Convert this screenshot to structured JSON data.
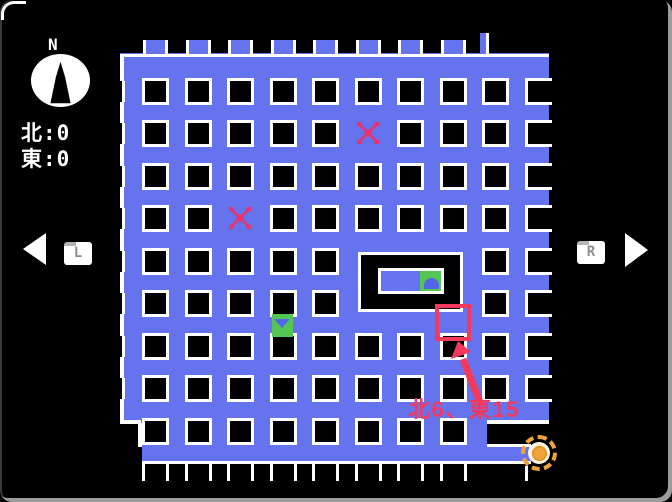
{
  "window": {
    "frame_color": "#9c9c9c",
    "screen_bg": "#000000"
  },
  "hud": {
    "compass": {
      "label": "N",
      "disc_color": "#ffffff",
      "needle_color": "#000000"
    },
    "coordinates": [
      {
        "label": "北",
        "separator": ":",
        "value": "0"
      },
      {
        "label": "東",
        "separator": ":",
        "value": "0"
      }
    ],
    "shoulder_buttons": [
      {
        "label": "L"
      },
      {
        "label": "R"
      }
    ]
  },
  "map": {
    "colors": {
      "floor": "#6673ef",
      "wall": "#000000",
      "outline": "#ffffff",
      "x_mark": "#e7336e",
      "annotation_red": "#f5395c",
      "tile_green": "#55c654",
      "icon_blue": "#5266e8",
      "target_orange": "#eea43b",
      "target_ring_bg": "#fdf3dc"
    },
    "x_marks": [
      {
        "x": 368,
        "y": 133
      },
      {
        "x": 240,
        "y": 218
      }
    ],
    "room": {
      "x": 358,
      "y": 252,
      "width": 105,
      "height": 60,
      "treasure": {
        "x": 378,
        "y": 268,
        "width": 66,
        "height": 26,
        "green_width": 21
      }
    },
    "green_arrow_tile": {
      "x": 272,
      "y": 314,
      "width": 21,
      "height": 23,
      "direction": "down"
    },
    "highlight_cell": {
      "x": 435,
      "y": 304,
      "width": 36,
      "height": 37,
      "note": "北6、東15"
    },
    "target": {
      "x": 539,
      "y": 453
    },
    "annotation": {
      "text": "北6、東15",
      "text_x": 408,
      "text_y": 392,
      "arrow_from_x": 481,
      "arrow_from_y": 405,
      "arrow_to_x": 458,
      "arrow_to_y": 341
    }
  }
}
